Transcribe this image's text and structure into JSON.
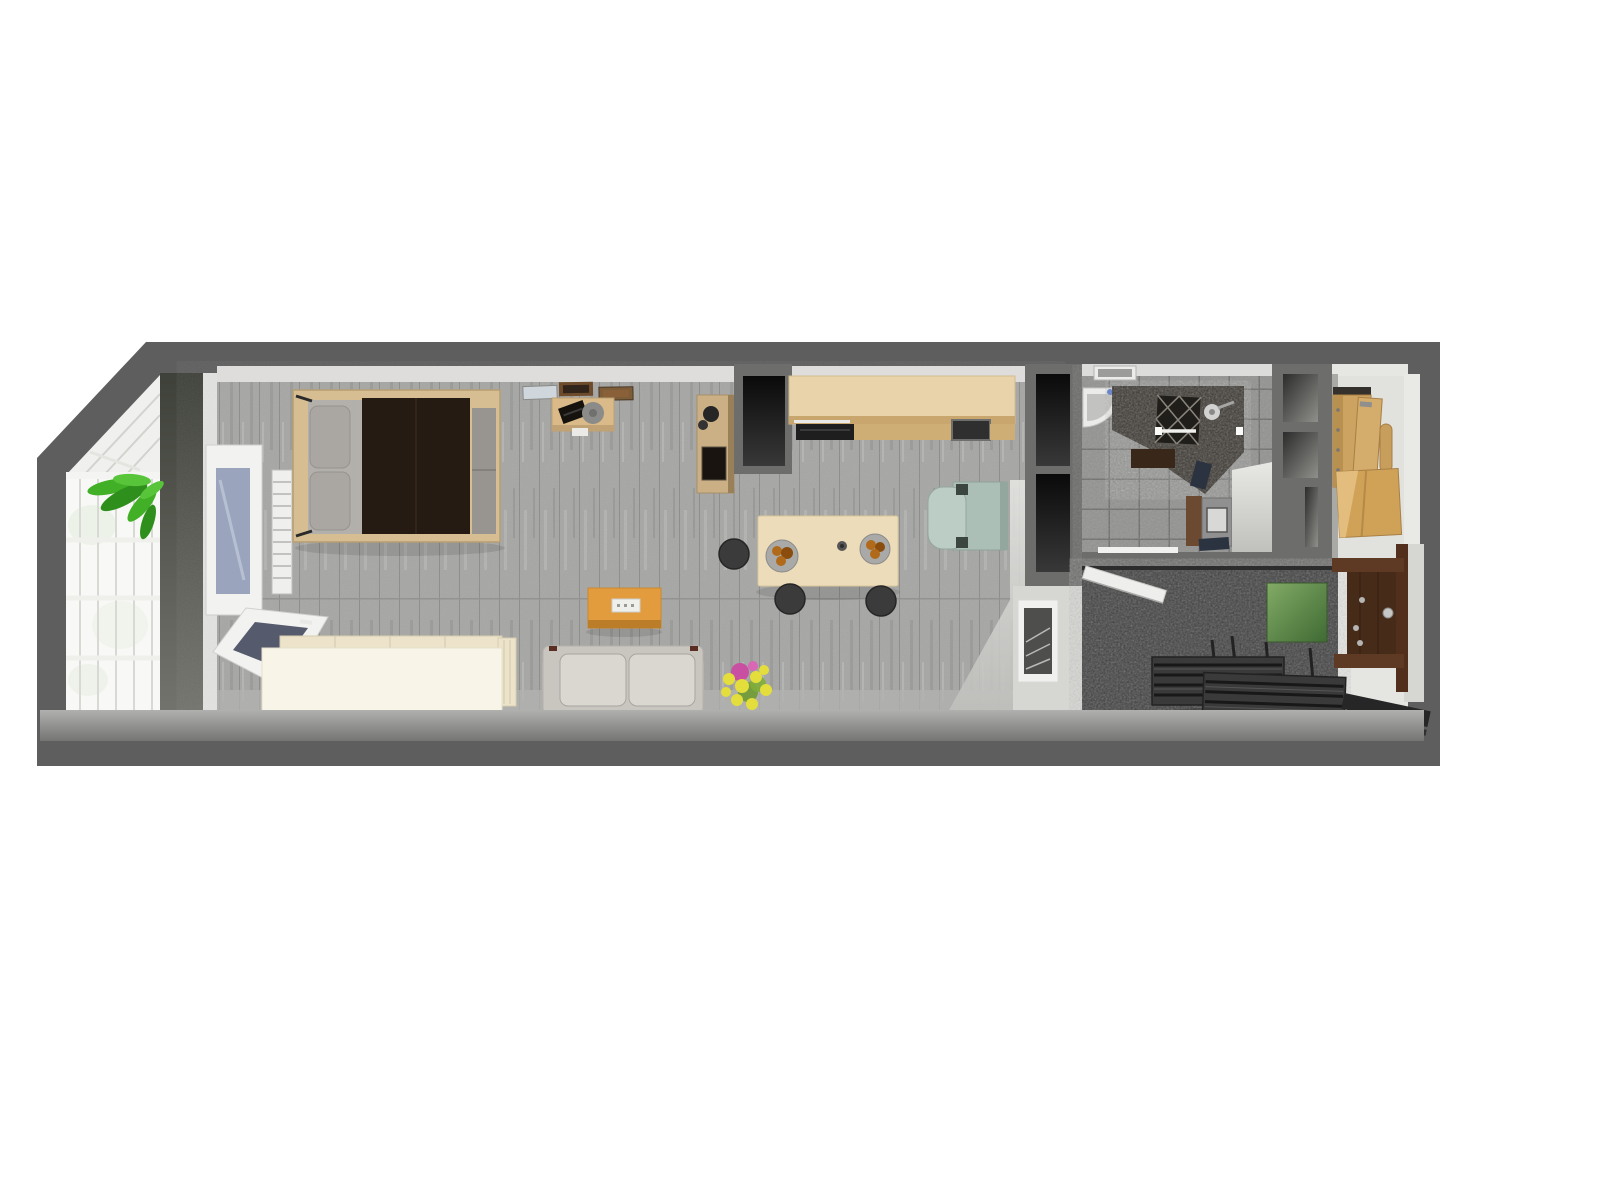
{
  "scene": {
    "title": "Top-down 3D render of a narrow studio apartment floor plan",
    "render_style": "3d-cutaway-floorplan"
  },
  "rooms": {
    "balcony": "glazed-winter-garden",
    "living": "studio-living-bedroom-kitchen",
    "bathroom": "bathroom",
    "closet": "wardrobe-closet",
    "hall": "entry-hall"
  },
  "colors": {
    "wallDark": "#5e5e5e",
    "wallMid": "#6d6d6b",
    "northFace": "#dedddb",
    "westFace": "#e3e3e1",
    "floorPlank": "#a6a6a4",
    "plankLine": "#8c8c8a",
    "lip": "#9e9e9c",
    "balconyGlass": "#f8f8f6",
    "balconyRoof": "#f0f0ee",
    "mullion": "#d8d8d4",
    "shadowBand": "#3e4139",
    "plantGreen": "#41b027",
    "plantGreenDark": "#2f8f1c",
    "bedFrame": "#d6bd92",
    "bedSheet": "#b3b0ab",
    "pillow": "#aaa7a2",
    "duvet": "#261b12",
    "endCushion": "#98948f",
    "radiator": "#efefed",
    "windowFrame": "#f2f2f0",
    "windowGlass": "#9aa5bd",
    "openPaneGlass": "#555a6c",
    "daybedFront": "#f8f4e8",
    "daybedTop": "#ece3ca",
    "picture1": "#cfd6dc",
    "picture2": "#6e4c2b",
    "picture3": "#7d5c38",
    "desk": "#d9ba88",
    "laptop": "#16130f",
    "deskChair": "#8b8b89",
    "shelfUnit": "#cbb086",
    "shelfArt": "#191410",
    "counter": "#e8d3aa",
    "counterEdge": "#c8a66d",
    "cooktop": "#1e1e1e",
    "sinkDark": "#2f2f2f",
    "diningTable": "#eddcba",
    "stool": "#3b3b3b",
    "plateRim": "#a9a9a7",
    "plateFood": "#b06a1a",
    "coffeeTable": "#e29c3e",
    "coffeeTableEdge": "#bb7d28",
    "sofaBase": "#c9c6c0",
    "sofaCushion": "#dad7d1",
    "flowerYellow": "#e4de3c",
    "flowerPink": "#c94fa2",
    "stemGreen": "#6f9a31",
    "armchair": "#abbfb7",
    "armchairLight": "#bccdc5",
    "armchairPost": "#3c4641",
    "eastWallFace": "#d6d6d3",
    "hatchFrame": "#f0f0ee",
    "hatchInner": "#4e4e4c",
    "tileFloor": "#929290",
    "tileLine": "#6f6f6d",
    "bathWallFace": "#dcdcda",
    "sinkWhite": "#ebebe9",
    "stone": "#39352f",
    "lattice": "#201e1b",
    "showerHead": "#d2d2d0",
    "bathMat": "#39281a",
    "towelNavy": "#2b3240",
    "vanityWood": "#6b4a31",
    "washer": "#909090",
    "washerDoor": "#d8d8d6",
    "closetFloor": "#e1e1de",
    "cabinetWood": "#cda361",
    "cabinetWoodLight": "#d4ac6c",
    "cabinetCap": "#34302b",
    "hallFloor": "#e5e5e2",
    "carpet": "#3f3f3f",
    "whiteDoor": "#eeeeec",
    "doorFrame": "#5e3a24",
    "doorPanel": "#472b19",
    "handle": "#c8c8c6",
    "doormat": "#262626"
  }
}
